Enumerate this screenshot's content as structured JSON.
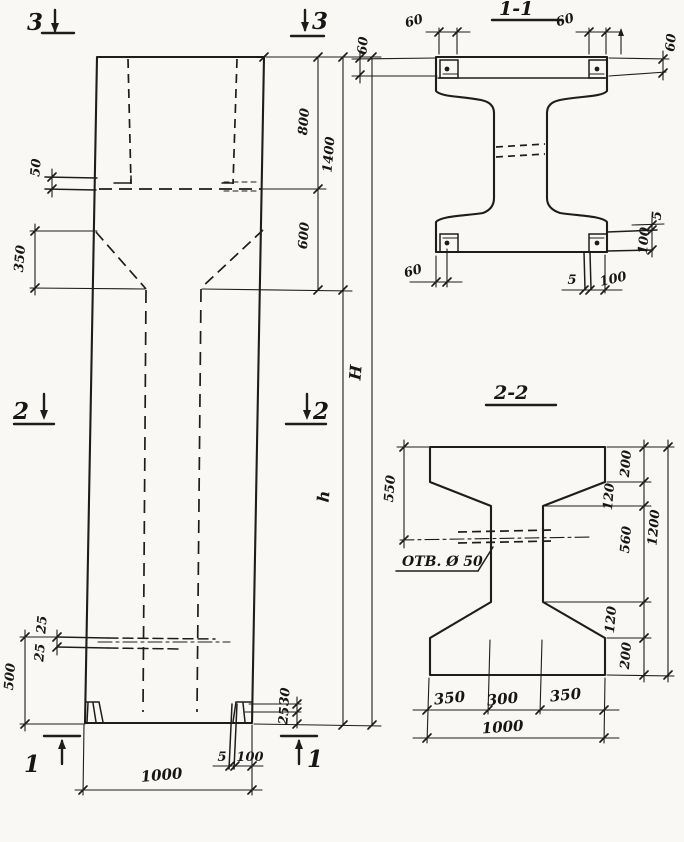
{
  "colors": {
    "ink": "#1d1d1d",
    "paper": "#f9f8f4"
  },
  "elevation": {
    "markers": {
      "m3l": "3",
      "m3r": "3",
      "m2l": "2",
      "m2r": "2",
      "m1l": "1",
      "m1r": "1"
    },
    "dims": {
      "plate": "50",
      "taper": "350",
      "hole_a": "25",
      "hole_b": "25",
      "base": "500",
      "head": "800",
      "neck": "600",
      "head_total": "1400",
      "shaft": "h",
      "total": "H",
      "lip_a": "30",
      "lip_b": "25",
      "plate_thk": "5",
      "plate_off": "100",
      "width": "1000"
    }
  },
  "section11": {
    "title": "1-1",
    "dims": {
      "tl": "60",
      "tr": "60",
      "left": "60",
      "right": "60",
      "bl": "60",
      "side_gap": "5",
      "side_plate": "100",
      "bottom_thk": "5",
      "bottom_off": "100"
    }
  },
  "section22": {
    "title": "2-2",
    "hole_label": "ОТВ. Ø 50",
    "dims": {
      "to_hole": "550",
      "flange_top": "200",
      "taper_top": "120",
      "web": "560",
      "taper_bottom": "120",
      "flange_bottom": "200",
      "height": "1200",
      "bottom_left": "350",
      "bottom_mid": "300",
      "bottom_right": "350",
      "width": "1000"
    }
  }
}
